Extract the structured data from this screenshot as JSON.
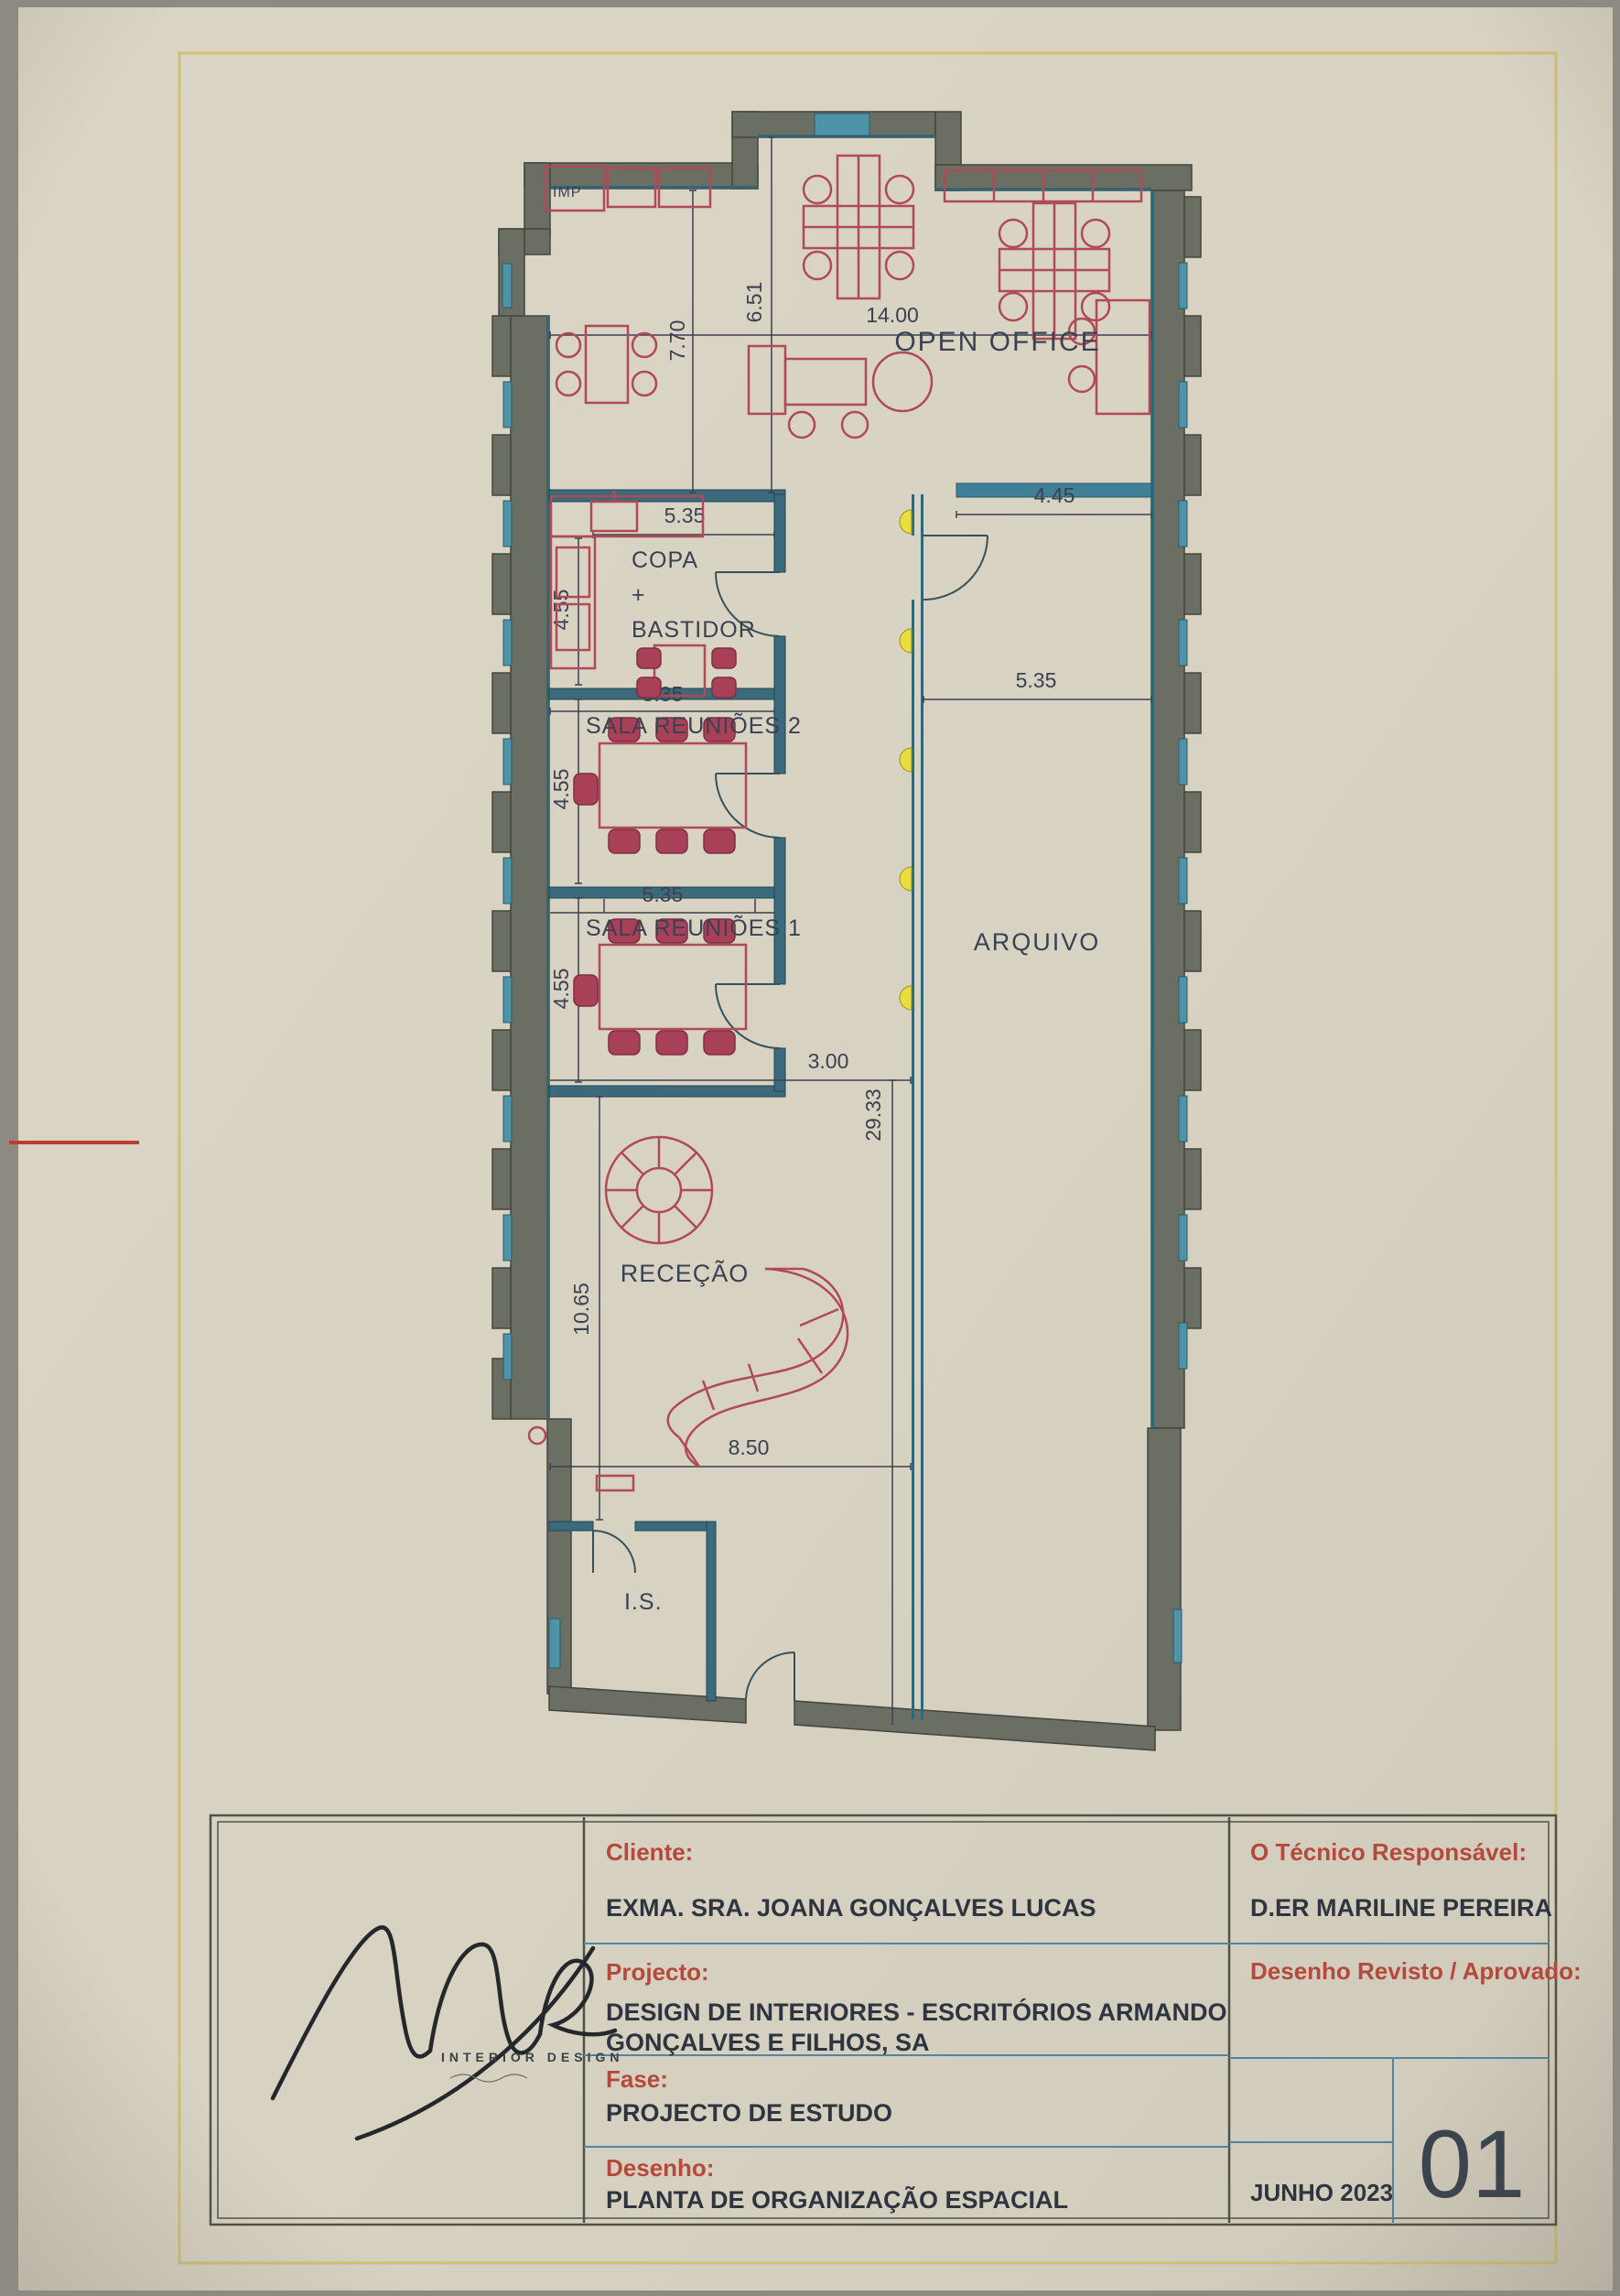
{
  "colors": {
    "paper": "#d8d2c2",
    "wall_gray": "#6b6e63",
    "wall_teal": "#2f6678",
    "window_teal": "#4e93a8",
    "partition_teal": "#3a6a7c",
    "furniture_red": "#b04a56",
    "dimension_ink": "#3b4150",
    "label_ink": "#394253",
    "title_red": "#b5493b",
    "light_yellow": "#e9de3d",
    "frame_yellow": "#cfc173",
    "mark_red": "#bf3a31"
  },
  "plan": {
    "rooms": {
      "open_office": "OPEN OFFICE",
      "copa_line1": "COPA",
      "copa_line2": "+",
      "copa_line3": "BASTIDOR",
      "sala_reunioes_2": "SALA REUNIÕES 2",
      "sala_reunioes_1": "SALA REUNIÕES 1",
      "arquivo": "ARQUIVO",
      "rececao": "RECEÇÃO",
      "is": "I.S."
    },
    "annotations": {
      "imp": "IMP"
    },
    "dimensions": {
      "open_office_width": "14.00",
      "open_office_depth_right": "6.51",
      "open_office_depth_left": "7.70",
      "balcony_width": "4.45",
      "copa_width": "5.35",
      "copa_depth": "4.55",
      "sala2_width": "5.35",
      "sala2_depth": "4.55",
      "sala1_width": "5.35",
      "sala1_depth": "4.55",
      "arquivo_width": "5.35",
      "corridor_width": "3.00",
      "corridor_length": "29.33",
      "rececao_depth": "10.65",
      "rececao_width": "8.50"
    }
  },
  "title_block": {
    "cliente_label": "Cliente:",
    "cliente_value": "EXMA. SRA. JOANA GONÇALVES LUCAS",
    "projecto_label": "Projecto:",
    "projecto_value_line1": "DESIGN DE INTERIORES - ESCRITÓRIOS ARMANDO",
    "projecto_value_line2": "GONÇALVES E FILHOS, SA",
    "fase_label": "Fase:",
    "fase_value": "PROJECTO DE ESTUDO",
    "desenho_label": "Desenho:",
    "desenho_value": "PLANTA DE ORGANIZAÇÃO ESPACIAL",
    "tecnico_label": "O Técnico Responsável:",
    "tecnico_value": "D.ER MARILINE PEREIRA",
    "revisto_label": "Desenho Revisto / Aprovado:",
    "date": "JUNHO 2023",
    "sheet_number": "01"
  },
  "logo": {
    "brand": "INTERIOR DESIGN"
  }
}
